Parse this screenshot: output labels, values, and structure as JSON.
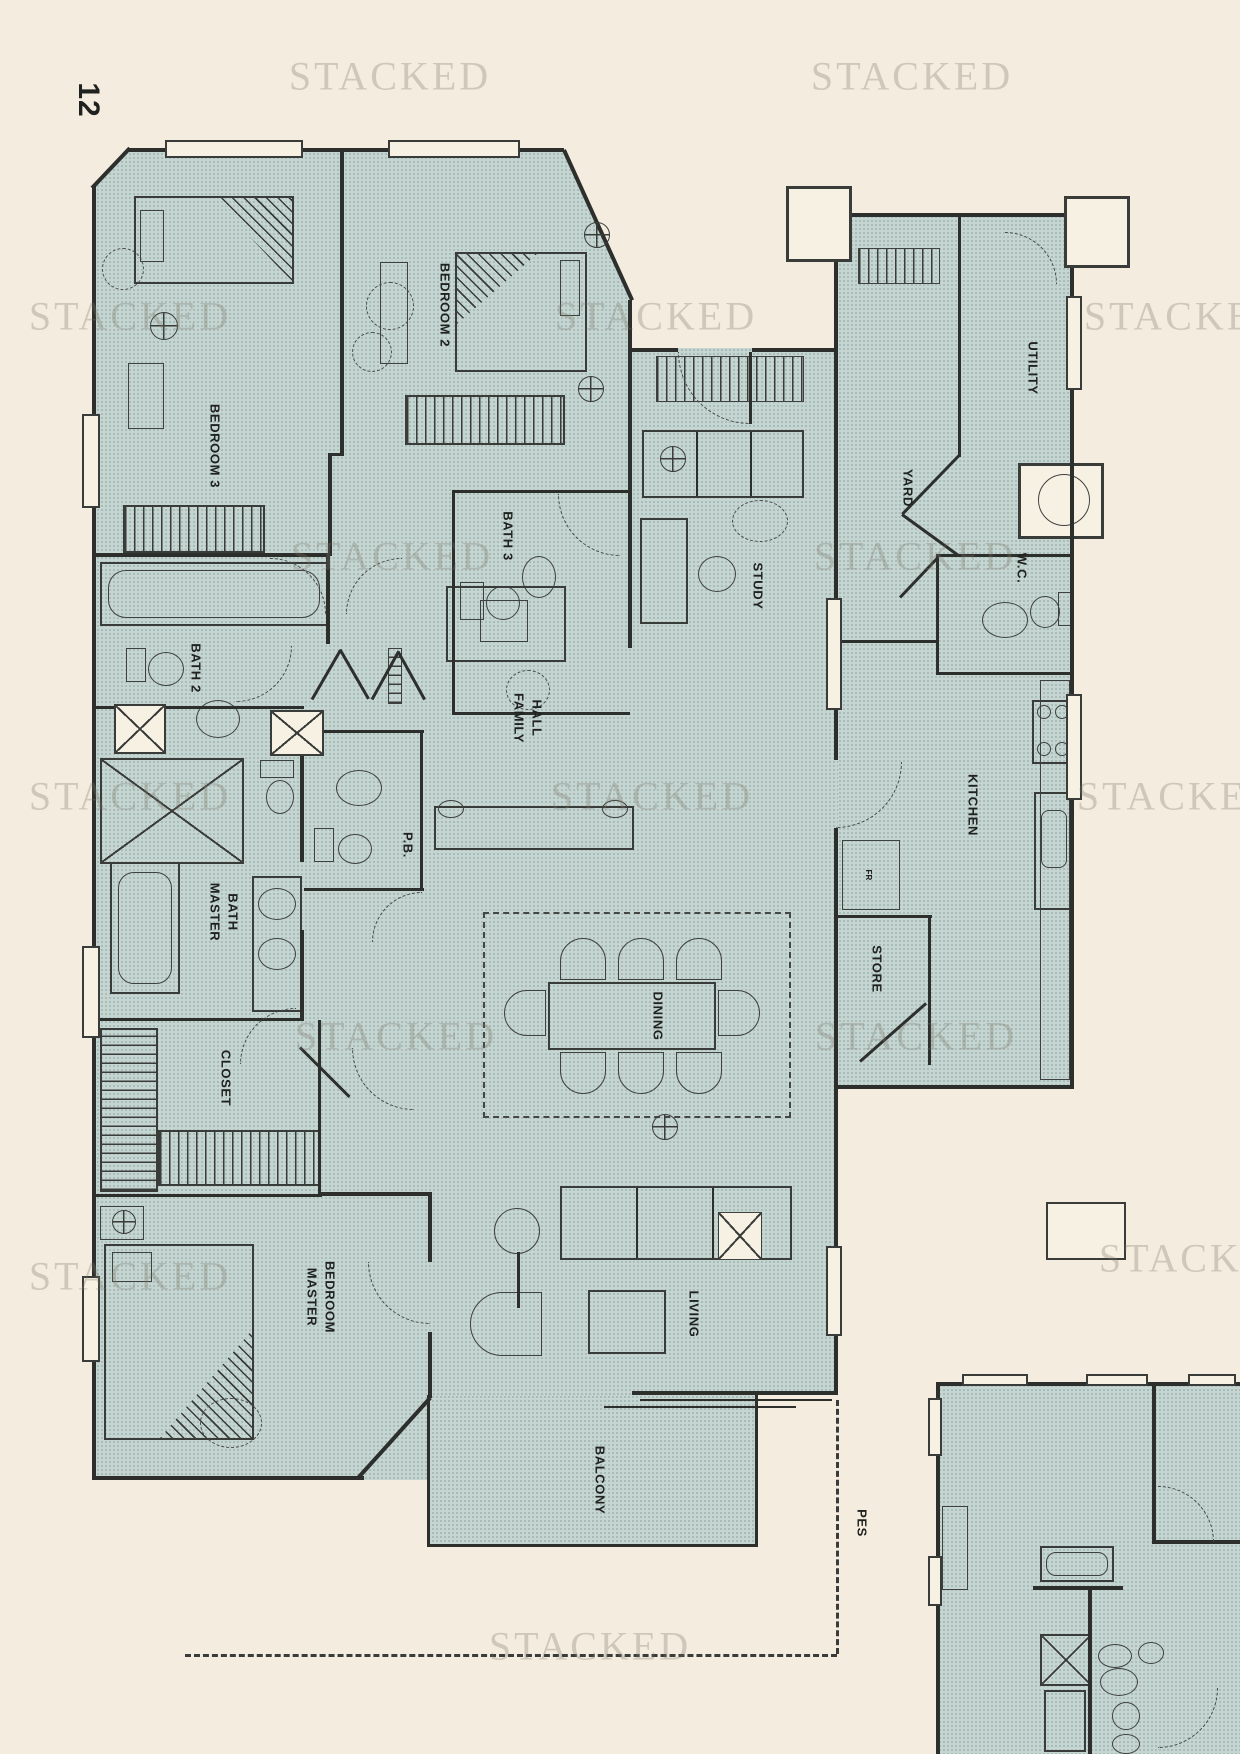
{
  "page": {
    "number": "12"
  },
  "watermark": {
    "text": "STACKED"
  },
  "labels": {
    "bedroom2": "BEDROOM 2",
    "bedroom3": "BEDROOM 3",
    "bath2": "BATH 2",
    "bath3": "BATH 3",
    "study": "STUDY",
    "family_hall": [
      "FAMILY",
      "HALL"
    ],
    "pb": "P.B.",
    "master_bath": [
      "MASTER",
      "BATH"
    ],
    "closet": "CLOSET",
    "master_bedroom": [
      "MASTER",
      "BEDROOM"
    ],
    "dining": "DINING",
    "living": "LIVING",
    "balcony": "BALCONY",
    "yard": "YARD",
    "utility": "UTILITY",
    "wc": "W.C.",
    "kitchen": "KITCHEN",
    "store": "STORE",
    "fridge": "FR",
    "pes": "PES"
  },
  "colors": {
    "background": "#f4eddf",
    "plan_fill": "#c5d6d2",
    "wall": "#2d2f2d",
    "watermark": "#7a7468"
  }
}
